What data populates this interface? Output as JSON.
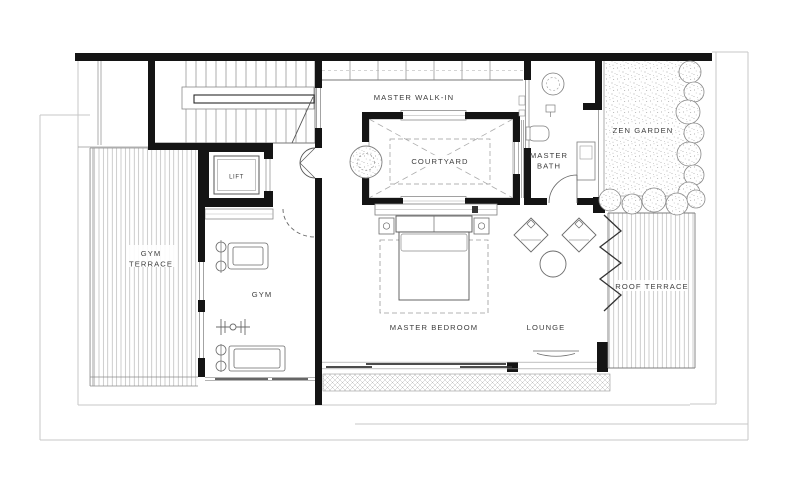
{
  "plan": {
    "rooms": {
      "lift": {
        "label": "LIFT"
      },
      "gym_terrace": {
        "line1": "GYM",
        "line2": "TERRACE"
      },
      "gym": {
        "label": "GYM"
      },
      "master_walk_in": {
        "label": "MASTER WALK-IN"
      },
      "courtyard": {
        "label": "COURTYARD"
      },
      "master_bath": {
        "line1": "MASTER",
        "line2": "BATH"
      },
      "zen_garden": {
        "label": "ZEN GARDEN"
      },
      "master_bedroom": {
        "label": "MASTER BEDROOM"
      },
      "lounge": {
        "label": "LOUNGE"
      },
      "roof_terrace": {
        "label": "ROOF TERRACE"
      }
    },
    "colors": {
      "background": "#ffffff",
      "wall": "#141414",
      "line": "#666666",
      "light_line": "#a8a8a8",
      "faint_boundary": "#c7c7c7",
      "text": "#3c3c3c"
    }
  }
}
